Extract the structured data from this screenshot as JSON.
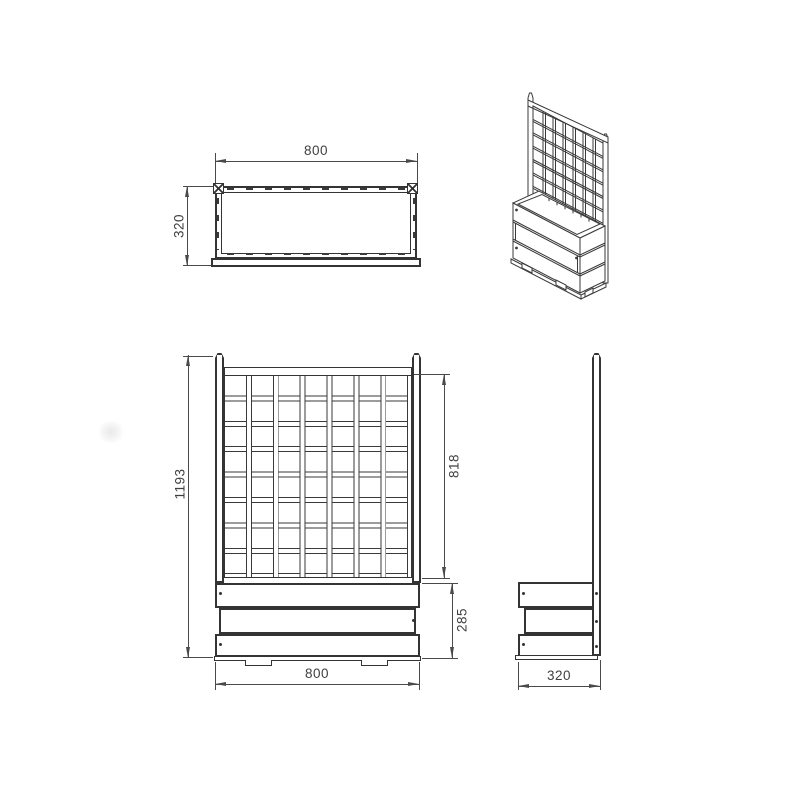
{
  "drawing": {
    "type": "technical-dimension-drawing",
    "subject": "planter box with trellis",
    "background": "#ffffff",
    "line_color": "#343434",
    "dim_color": "#4a4a4a",
    "views": {
      "top": {
        "name": "top view",
        "width_label": "800",
        "depth_label": "320"
      },
      "isometric": {
        "name": "isometric view"
      },
      "front": {
        "name": "front view",
        "overall_height_label": "1193",
        "trellis_height_label": "818",
        "planter_height_label": "285",
        "width_label": "800",
        "trellis_columns": 7,
        "trellis_rows": 8
      },
      "side": {
        "name": "side view",
        "depth_label": "320"
      }
    },
    "dimensions_mm": {
      "width": 800,
      "depth": 320,
      "overall_height": 1193,
      "trellis_height": 818,
      "planter_height": 285
    }
  }
}
